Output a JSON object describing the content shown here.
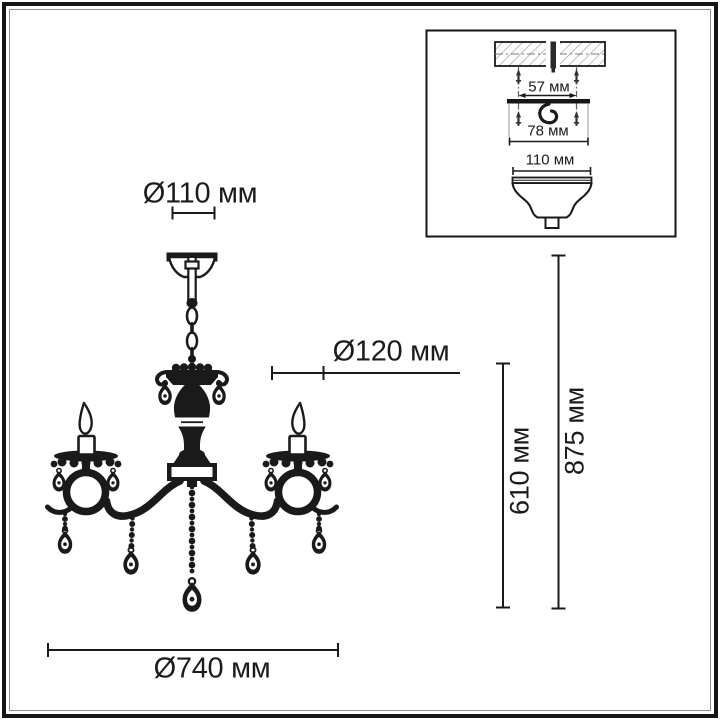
{
  "title": "Схема размеров люстры",
  "colors": {
    "ink": "#1a1a1a",
    "background": "#ffffff",
    "hatch": "#9b9b9b",
    "extension_line": "#999999"
  },
  "main_view": {
    "labels": {
      "canopy_diameter": "Ø110 мм",
      "cup_diameter": "Ø120 мм",
      "overall_width": "Ø740 мм",
      "body_height": "610 мм",
      "overall_height": "875 мм"
    }
  },
  "inset_view": {
    "labels": {
      "screw_spacing": "57 мм",
      "bracket_width": "78 мм",
      "canopy_diameter": "110 мм"
    }
  }
}
